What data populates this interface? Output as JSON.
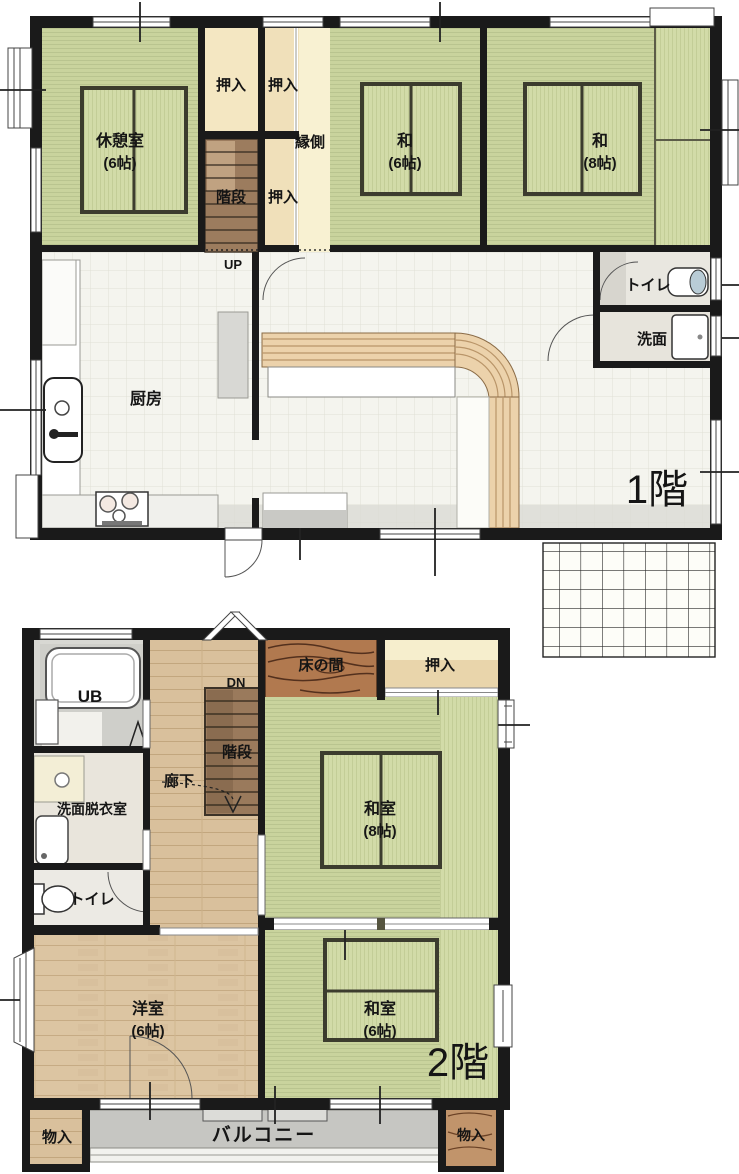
{
  "plan_title": "2-story Japanese house floor plan",
  "colors": {
    "wall": "#1a1a1a",
    "tatami_green": "#ccd6a2",
    "tatami_stripe": "#b9c38e",
    "engawa_cream": "#f8f1d2",
    "closet_beige": "#f0e2bd",
    "stair_wood": "#9c7c5e",
    "tokonoma_wood": "#b1794f",
    "plank_wood": "#dcc5a2",
    "tile_floor": "#f4f4ee",
    "balcony_gray": "#c6c6c2",
    "counter_wood": "#ecd2ab"
  },
  "floor1": {
    "label": "1階",
    "rest_room": {
      "name": "休憩室",
      "size": "(6帖)"
    },
    "closet_top_left": "押入",
    "closet_top_right": "押入",
    "stairs": "階段",
    "closet_mid": "押入",
    "up": "UP",
    "engawa": "縁側",
    "tatami6": {
      "name": "和",
      "size": "(6帖)"
    },
    "tatami8": {
      "name": "和",
      "size": "(8帖)"
    },
    "toilet": "トイレ",
    "washroom": "洗面",
    "kitchen": "厨房"
  },
  "floor2": {
    "label": "2階",
    "unit_bath": "UB",
    "dn": "DN",
    "stairs": "階段",
    "hallway": "廊下",
    "tokonoma": "床の間",
    "closet": "押入",
    "washroom_dressing": "洗面脱衣室",
    "toilet": "トイレ",
    "tatami8": {
      "name": "和室",
      "size": "(8帖)"
    },
    "western6": {
      "name": "洋室",
      "size": "(6帖)"
    },
    "tatami6": {
      "name": "和室",
      "size": "(6帖)"
    },
    "storage_left": "物入",
    "balcony": "バルコニー",
    "storage_right": "物入"
  }
}
